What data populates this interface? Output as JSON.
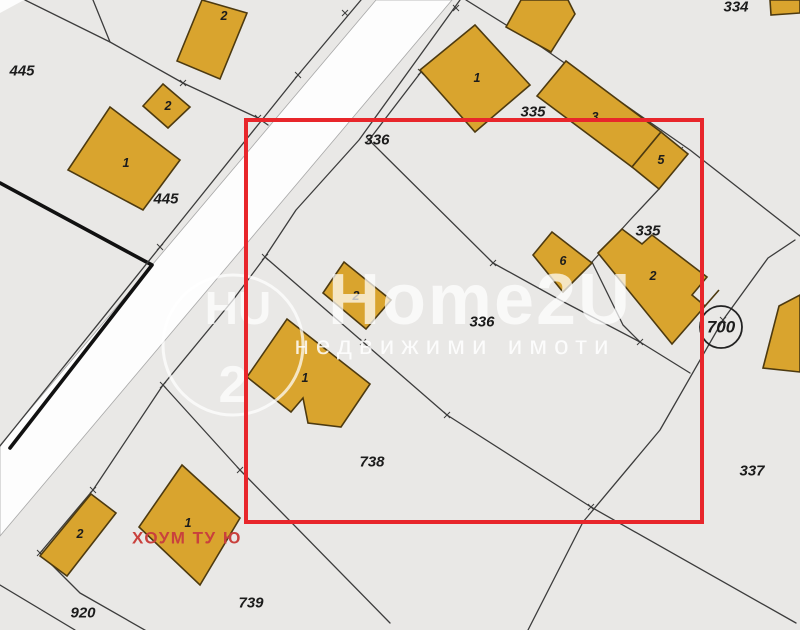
{
  "map_meta": {
    "kind": "cadastral-parcel-map",
    "selection_note": "red rectangle highlighting parcels 336/335/738"
  },
  "colors": {
    "background": "#e9e8e6",
    "road": "#fdfdfd",
    "road_edge": "#a8a8a8",
    "line": "#3c3c3c",
    "thick_line": "#111111",
    "building_fill": "#d9a42e",
    "building_stroke": "#4d3a10",
    "label_color": "#1c1c1c",
    "selection": "#e8262b",
    "agency": "#c9413d",
    "watermark": "rgba(255,255,255,0.72)",
    "watermark_strong": "rgba(255,255,255,0.85)"
  },
  "watermark": {
    "brand": "Home2U",
    "tagline": "недвижими имоти",
    "monogram_top": "HU",
    "monogram_bottom": "2"
  },
  "agency_label": {
    "text": "ХОУМ ТУ Ю",
    "x": 132,
    "y": 538
  },
  "selection_rect": {
    "x": 246,
    "y": 120,
    "w": 456,
    "h": 402
  },
  "map": {
    "white_corner": "0,0 24,0 0,13",
    "road": "376,0 452,0 0,536 0,445",
    "boundaries": [
      {
        "name": "thick-boundary",
        "points": "0,183 152,265 10,448",
        "width": 3.6,
        "color": "#111111"
      },
      {
        "name": "road-left-boundary",
        "points": "361,0 298,75 160,247 0,446"
      },
      {
        "name": "road-right-boundary",
        "points": "460,0 359,140 296,210 265,257 233,300 163,385 93,490 40,553 80,593 150,633"
      },
      {
        "name": "parcel-445-diagonal",
        "points": "25,0 110,42 183,83 258,118 268,125"
      },
      {
        "name": "parcel-445-short",
        "points": "93,0 110,42"
      },
      {
        "name": "parcel-336-north",
        "points": "421,72 369,140 493,263 560,300 640,342 690,373"
      },
      {
        "name": "parcel-335-northwest",
        "points": "466,0 540,46"
      },
      {
        "name": "parcel-334-335",
        "points": "540,46 690,150 800,236"
      },
      {
        "name": "parcel-335-inner-a",
        "points": "592,262 630,220 659,189"
      },
      {
        "name": "parcel-335-inner-b",
        "points": "592,262 623,325 640,342"
      },
      {
        "name": "parcel-east-boundary",
        "points": "795,240 768,258 723,320 660,430 583,522 528,630"
      },
      {
        "name": "parcel-738-south",
        "points": "265,257 363,342 447,415 591,507 796,623"
      },
      {
        "name": "parcel-739-west",
        "points": "163,385 240,470 390,623"
      },
      {
        "name": "parcel-920-south",
        "points": "0,585 75,630"
      }
    ],
    "ticks": [
      [
        345,
        13
      ],
      [
        298,
        75
      ],
      [
        183,
        83
      ],
      [
        258,
        118
      ],
      [
        160,
        247
      ],
      [
        369,
        140
      ],
      [
        421,
        72
      ],
      [
        493,
        263
      ],
      [
        640,
        342
      ],
      [
        680,
        150
      ],
      [
        723,
        320
      ],
      [
        363,
        342
      ],
      [
        447,
        415
      ],
      [
        591,
        507
      ],
      [
        163,
        385
      ],
      [
        240,
        470
      ],
      [
        93,
        490
      ],
      [
        40,
        553
      ],
      [
        456,
        8
      ],
      [
        265,
        257
      ]
    ],
    "buildings": [
      {
        "points": "177,61 202,0 247,13 220,79",
        "label": "2",
        "lx": 224,
        "ly": 16
      },
      {
        "points": "163,84 190,107 168,128 143,106",
        "label": "2",
        "lx": 168,
        "ly": 106
      },
      {
        "points": "110,107 180,160 143,210 68,170",
        "label": "1",
        "lx": 126,
        "ly": 163
      },
      {
        "points": "420,70 475,25 530,85 475,132",
        "label": "1",
        "lx": 477,
        "ly": 78
      },
      {
        "points": "506,27 521,0 568,0 575,14 551,52",
        "label": "",
        "lx": 0,
        "ly": 0
      },
      {
        "points": "770,0 800,0 800,13 771,15",
        "label": "",
        "lx": 0,
        "ly": 0
      },
      {
        "points": "537,96 566,61 661,132 632,167",
        "label": "3",
        "lx": 595,
        "ly": 117
      },
      {
        "points": "632,167 661,132 688,154 659,189",
        "label": "5",
        "lx": 661,
        "ly": 160
      },
      {
        "points": "552,232 592,263 563,292 533,255",
        "label": "6",
        "lx": 563,
        "ly": 261
      },
      {
        "points": "598,253 622,229 642,244 652,235 707,277 692,295 705,306 719,290 672,344",
        "label": "2",
        "lx": 653,
        "ly": 276
      },
      {
        "points": "779,306 800,295 800,372 763,368",
        "label": "",
        "lx": 0,
        "ly": 0
      },
      {
        "points": "344,262 391,300 366,329 323,293",
        "label": "2",
        "lx": 356,
        "ly": 296
      },
      {
        "points": "287,319 370,384 341,427 308,423 303,398 291,412 247,377",
        "label": "1",
        "lx": 305,
        "ly": 378
      },
      {
        "points": "91,494 116,513 67,576 40,556",
        "label": "2",
        "lx": 80,
        "ly": 534
      },
      {
        "points": "182,465 240,518 200,585 139,527",
        "label": "1",
        "lx": 188,
        "ly": 523
      }
    ],
    "parcel_labels": [
      {
        "text": "445",
        "x": 22,
        "y": 71
      },
      {
        "text": "445",
        "x": 166,
        "y": 199
      },
      {
        "text": "334",
        "x": 736,
        "y": 7
      },
      {
        "text": "335",
        "x": 533,
        "y": 112
      },
      {
        "text": "335",
        "x": 648,
        "y": 231
      },
      {
        "text": "336",
        "x": 377,
        "y": 140
      },
      {
        "text": "336",
        "x": 482,
        "y": 322
      },
      {
        "text": "337",
        "x": 752,
        "y": 471
      },
      {
        "text": "738",
        "x": 372,
        "y": 462
      },
      {
        "text": "739",
        "x": 251,
        "y": 603
      },
      {
        "text": "920",
        "x": 83,
        "y": 613
      }
    ],
    "circle_label": {
      "text": "700",
      "cx": 721,
      "cy": 327,
      "r": 21
    }
  }
}
